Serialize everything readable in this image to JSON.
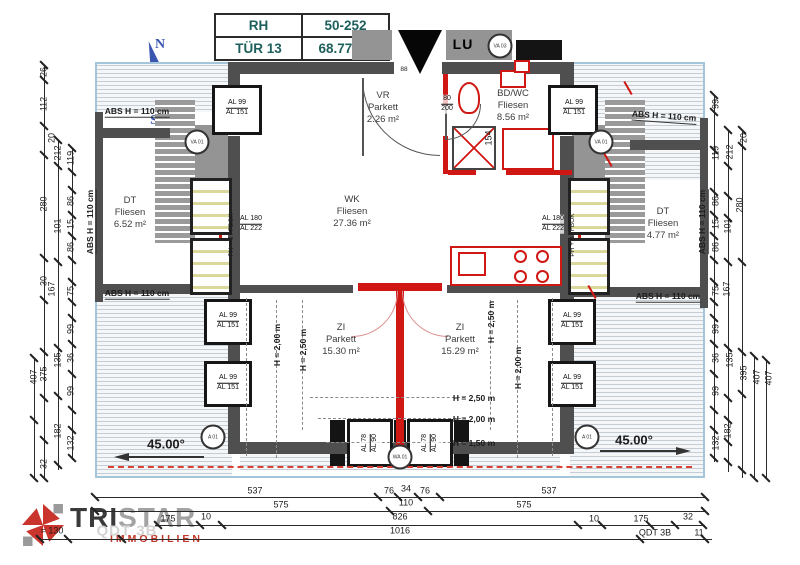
{
  "title_block": {
    "r1c1": "RH",
    "r1c2": "50-252",
    "r2c1": "TÜR 13",
    "r2c2": "68.77 m²"
  },
  "compass": {
    "n": "N",
    "e": "E",
    "s": "S",
    "w": "W"
  },
  "logo": {
    "brand_bold": "TRI",
    "brand_light": "STAR",
    "subtitle": "IMMOBILIEN"
  },
  "rooms": [
    {
      "name": "VR",
      "material": "Parkett",
      "area": "2.26 m²",
      "x": 383,
      "y": 108
    },
    {
      "name": "BD/WC",
      "material": "Fliesen",
      "area": "8.56 m²",
      "x": 513,
      "y": 106
    },
    {
      "name": "WK",
      "material": "Fliesen",
      "area": "27.36 m²",
      "x": 352,
      "y": 212
    },
    {
      "name": "DT",
      "material": "Fliesen",
      "area": "6.52 m²",
      "x": 130,
      "y": 213
    },
    {
      "name": "DT",
      "material": "Fliesen",
      "area": "4.77 m²",
      "x": 663,
      "y": 224
    },
    {
      "name": "ZI",
      "material": "Parkett",
      "area": "15.30 m²",
      "x": 341,
      "y": 340
    },
    {
      "name": "ZI",
      "material": "Parkett",
      "area": "15.29 m²",
      "x": 460,
      "y": 340
    }
  ],
  "annotations": [
    {
      "t": "LU",
      "x": 463,
      "y": 44,
      "cls": "lu"
    },
    {
      "t": "ABS H = 110 cm",
      "x": 137,
      "y": 112,
      "cls": "absl",
      "rot": 0
    },
    {
      "t": "ABS H = 110 cm",
      "x": 664,
      "y": 117,
      "cls": "absl",
      "rot": 4
    },
    {
      "t": "ABS H = 110 cm",
      "x": 137,
      "y": 294,
      "cls": "absl",
      "rot": 0
    },
    {
      "t": "ABS H = 110 cm",
      "x": 668,
      "y": 297,
      "cls": "absl",
      "rot": 0
    },
    {
      "t": "ABS H = 110 cm",
      "x": 91,
      "y": 222,
      "cls": "absl",
      "rot": -90
    },
    {
      "t": "ABS H = 110 cm",
      "x": 703,
      "y": 222,
      "cls": "absl",
      "rot": -90
    },
    {
      "t": "H = 2,00 m",
      "x": 277,
      "y": 345,
      "rot": -90,
      "cls": "hl"
    },
    {
      "t": "H = 2,50 m",
      "x": 303,
      "y": 350,
      "rot": -90,
      "cls": "hl"
    },
    {
      "t": "H = 2,50 m",
      "x": 491,
      "y": 322,
      "rot": -90,
      "cls": "hl"
    },
    {
      "t": "H = 2,00 m",
      "x": 518,
      "y": 368,
      "rot": -90,
      "cls": "hl"
    },
    {
      "t": "H = 2,50 m",
      "x": 474,
      "y": 398,
      "cls": "hl"
    },
    {
      "t": "H = 2,00 m",
      "x": 474,
      "y": 419,
      "cls": "hl"
    },
    {
      "t": "H = 1,50 m",
      "x": 474,
      "y": 443,
      "cls": "hl"
    },
    {
      "t": "45.00°",
      "x": 166,
      "y": 444,
      "cls": "ang"
    },
    {
      "t": "45.00°",
      "x": 634,
      "y": 440,
      "cls": "ang"
    },
    {
      "t": "PH + 0 / FBOK",
      "x": 232,
      "y": 235,
      "rot": -90,
      "cls": "tiny"
    },
    {
      "t": "PH + 0 / FBOK",
      "x": 573,
      "y": 235,
      "rot": -90,
      "cls": "tiny"
    },
    {
      "t": "154",
      "x": 489,
      "y": 138,
      "rot": -90,
      "cls": "dim"
    },
    {
      "t": "88",
      "x": 404,
      "y": 70,
      "cls": "tiny"
    },
    {
      "t": "QDT 3B",
      "x": 127,
      "y": 531,
      "cls": "wm"
    }
  ],
  "window_labels": [
    {
      "l1": "AL 99",
      "l2": "AL 151",
      "x": 237,
      "y": 108,
      "rot": 0
    },
    {
      "l1": "AL 99",
      "l2": "AL 151",
      "x": 574,
      "y": 108,
      "rot": 0
    },
    {
      "l1": "AL 99",
      "l2": "AL 151",
      "x": 228,
      "y": 321,
      "rot": 0
    },
    {
      "l1": "AL 99",
      "l2": "AL 151",
      "x": 228,
      "y": 383,
      "rot": 0
    },
    {
      "l1": "AL 99",
      "l2": "AL 151",
      "x": 572,
      "y": 321,
      "rot": 0
    },
    {
      "l1": "AL 99",
      "l2": "AL 151",
      "x": 572,
      "y": 383,
      "rot": 0
    },
    {
      "l1": "AL 180",
      "l2": "AL 222",
      "x": 251,
      "y": 224,
      "rot": 0
    },
    {
      "l1": "AL 180",
      "l2": "AL 222",
      "x": 553,
      "y": 224,
      "rot": 0
    },
    {
      "l1": "AL 78",
      "l2": "AL 90",
      "x": 370,
      "y": 443,
      "rot": -90
    },
    {
      "l1": "AL 78",
      "l2": "AL 90",
      "x": 430,
      "y": 443,
      "rot": -90
    },
    {
      "l1": "80",
      "l2": "200",
      "x": 447,
      "y": 104,
      "rot": 0
    }
  ],
  "markers": [
    {
      "t": "VA 03",
      "x": 500,
      "y": 46
    },
    {
      "t": "VA 01",
      "x": 197,
      "y": 142
    },
    {
      "t": "VA 01",
      "x": 601,
      "y": 142
    },
    {
      "t": "A 01",
      "x": 213,
      "y": 437
    },
    {
      "t": "A 01",
      "x": 587,
      "y": 437
    },
    {
      "t": "WA 01",
      "x": 400,
      "y": 457
    }
  ],
  "dims": {
    "left": [
      [
        "26",
        44,
        72
      ],
      [
        "112",
        44,
        104
      ],
      [
        "20",
        52,
        138
      ],
      [
        "212",
        58,
        153
      ],
      [
        "119",
        71,
        158
      ],
      [
        "280",
        44,
        204
      ],
      [
        "86",
        71,
        201
      ],
      [
        "101",
        58,
        226
      ],
      [
        "15",
        71,
        224
      ],
      [
        "86",
        71,
        247
      ],
      [
        "30",
        44,
        281
      ],
      [
        "167",
        52,
        289
      ],
      [
        "75",
        71,
        291
      ],
      [
        "99",
        71,
        329
      ],
      [
        "36",
        71,
        358
      ],
      [
        "135",
        58,
        360
      ],
      [
        "375",
        44,
        374
      ],
      [
        "407",
        34,
        377
      ],
      [
        "99",
        71,
        391
      ],
      [
        "182",
        58,
        431
      ],
      [
        "132",
        71,
        443
      ],
      [
        "32",
        44,
        464
      ]
    ],
    "right": [
      [
        "99",
        716,
        104
      ],
      [
        "119",
        716,
        153
      ],
      [
        "212",
        730,
        152
      ],
      [
        "20",
        744,
        138
      ],
      [
        "86",
        716,
        201
      ],
      [
        "280",
        740,
        205
      ],
      [
        "15",
        716,
        224
      ],
      [
        "101",
        728,
        226
      ],
      [
        "86",
        716,
        247
      ],
      [
        "75",
        716,
        291
      ],
      [
        "167",
        727,
        289
      ],
      [
        "99",
        716,
        329
      ],
      [
        "36",
        716,
        358
      ],
      [
        "135",
        730,
        360
      ],
      [
        "395",
        744,
        373
      ],
      [
        "407",
        757,
        377
      ],
      [
        "407",
        769,
        378
      ],
      [
        "99",
        716,
        391
      ],
      [
        "182",
        728,
        431
      ],
      [
        "132",
        716,
        443
      ]
    ],
    "bottom": [
      [
        "537",
        255,
        491
      ],
      [
        "76",
        389,
        491
      ],
      [
        "34",
        406,
        489
      ],
      [
        "76",
        425,
        491
      ],
      [
        "537",
        549,
        491
      ],
      [
        "575",
        281,
        505
      ],
      [
        "110",
        406,
        503
      ],
      [
        "575",
        524,
        505
      ],
      [
        "175",
        168,
        519
      ],
      [
        "10",
        206,
        517
      ],
      [
        "826",
        400,
        517
      ],
      [
        "10",
        594,
        519
      ],
      [
        "175",
        641,
        519
      ],
      [
        "32",
        688,
        517
      ],
      [
        "= 130",
        52,
        531
      ],
      [
        "1016",
        400,
        531
      ],
      [
        "QDT 3B",
        655,
        533
      ],
      [
        "11",
        699,
        533
      ]
    ]
  }
}
